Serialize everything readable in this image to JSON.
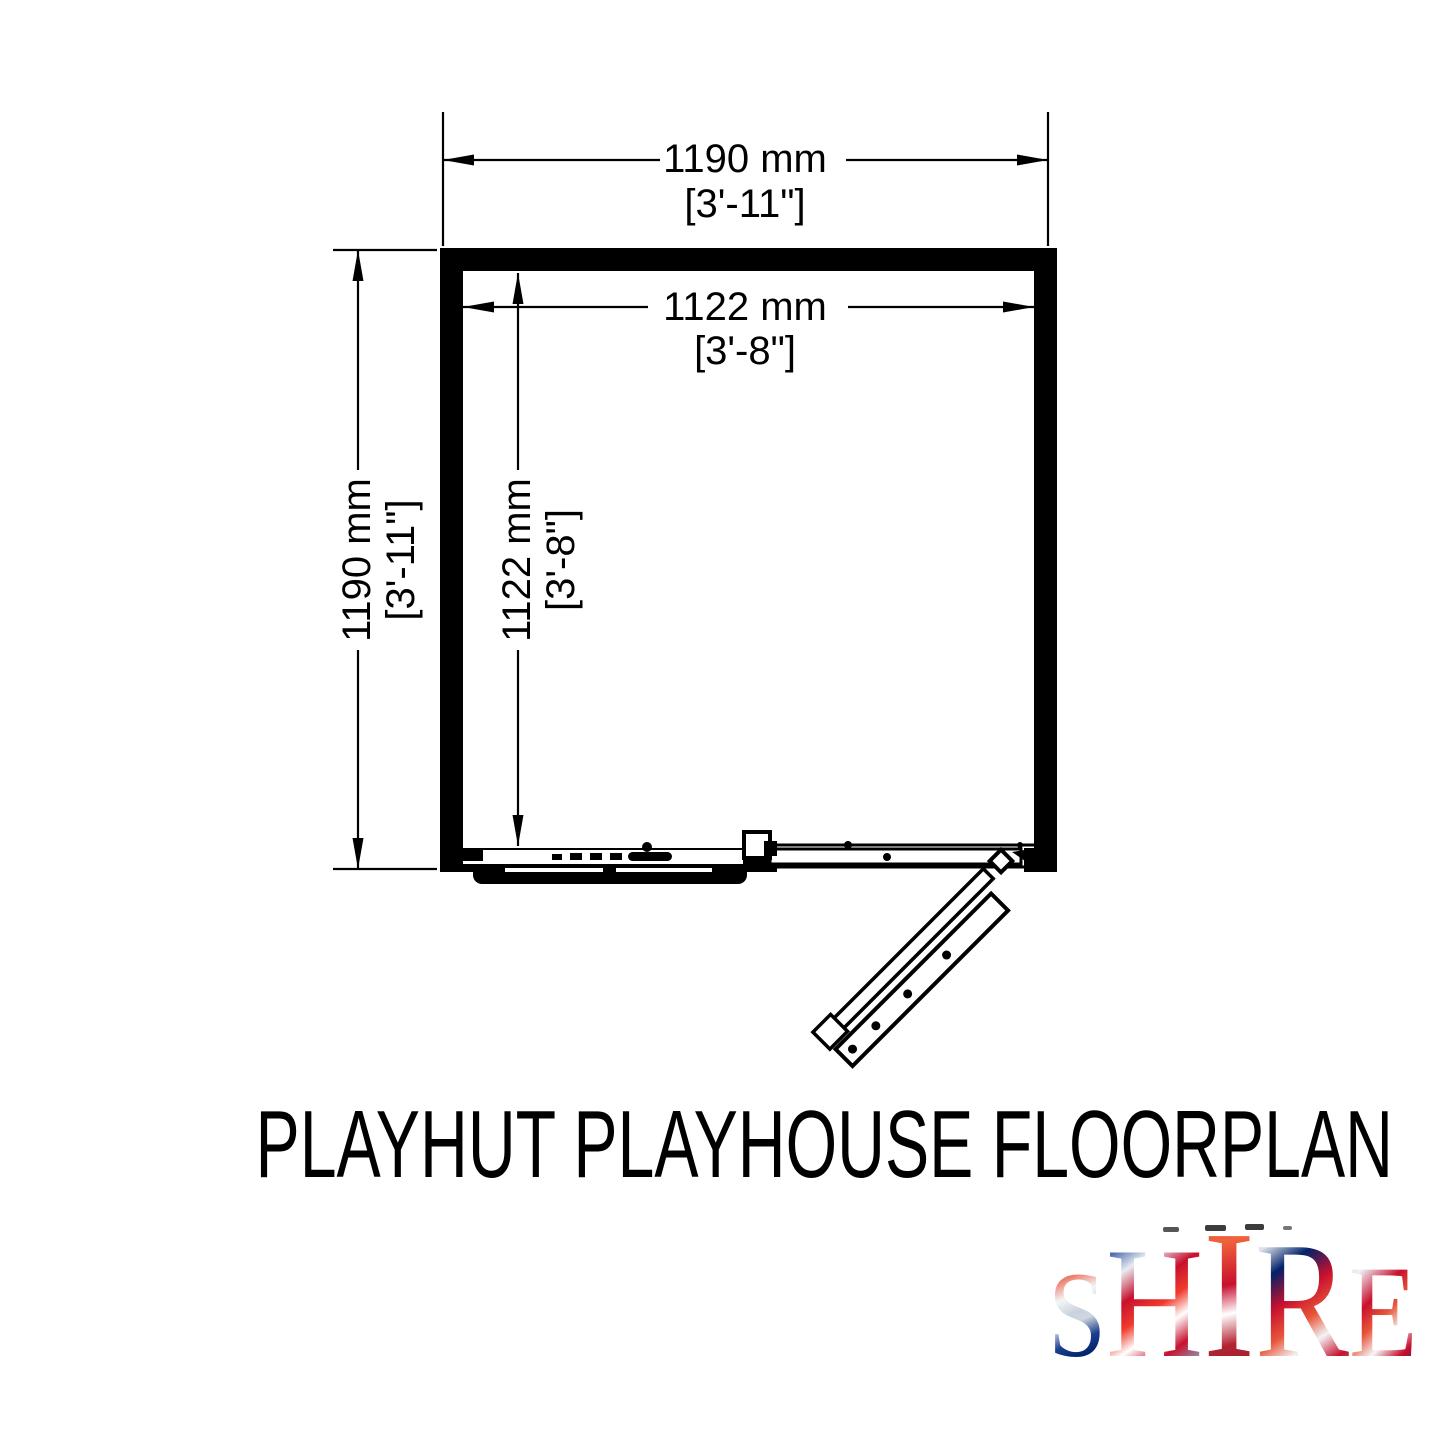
{
  "title": "PLAYHUT PLAYHOUSE FLOORPLAN",
  "dimensions": {
    "outer_width": {
      "metric": "1190 mm",
      "imperial": "[3'-11\"]"
    },
    "inner_width": {
      "metric": "1122 mm",
      "imperial": "[3'-8\"]"
    },
    "outer_depth": {
      "metric": "1190 mm",
      "imperial": "[3'-11\"]"
    },
    "inner_depth": {
      "metric": "1122 mm",
      "imperial": "[3'-8\"]"
    }
  },
  "logo": {
    "letters": [
      "S",
      "H",
      "I",
      "R",
      "E"
    ],
    "tagline": "BUILT AROUND OUR REPUTATION",
    "colors": {
      "flag_red": "#C8102E",
      "flag_blue": "#012169",
      "silver": "#C9D1DB",
      "ink": "#000000"
    }
  }
}
